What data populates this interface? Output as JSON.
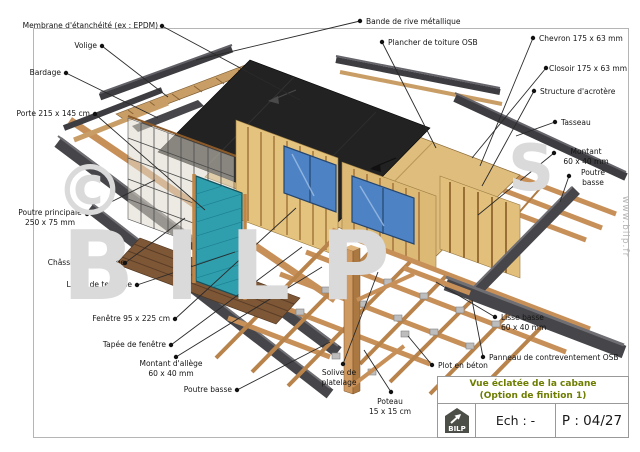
{
  "drawing_labels": [
    {
      "text": "Membrane d'étanchéité (ex : EPDM)"
    },
    {
      "text": "Volige"
    },
    {
      "text": "Bardage"
    },
    {
      "text": "Porte 215 x 145 cm"
    },
    {
      "text": "Poutre principale\n250 x 75 mm"
    },
    {
      "text": "Châssis à galandage"
    },
    {
      "text": "Lame de terrasse"
    },
    {
      "text": "Fenêtre 95 x 225 cm"
    },
    {
      "text": "Tapée de fenêtre"
    },
    {
      "text": "Montant d'allège\n60 x 40 mm"
    },
    {
      "text": "Poutre basse"
    },
    {
      "text": "Solive de\nplatelage"
    },
    {
      "text": "Poteau\n15 x 15 cm"
    },
    {
      "text": "Bande de rive métallique"
    },
    {
      "text": "Plancher de toiture OSB"
    },
    {
      "text": "Chevron 175 x 63 mm"
    },
    {
      "text": "Closoir 175 x 63 mm"
    },
    {
      "text": "Structure d'acrotère"
    },
    {
      "text": "Tasseau"
    },
    {
      "text": "Montant\n60 x 40 mm"
    },
    {
      "text": "Poutre\nbasse"
    },
    {
      "text": "Lisse basse\n60 x 40 mm"
    },
    {
      "text": "Panneau de contreventement OSB"
    },
    {
      "text": "Plot en béton"
    }
  ],
  "title_block": {
    "title_line1": "Vue éclatée de la cabane",
    "title_line2": "(Option de finition 1)",
    "scale_label": "Ech : -",
    "page_label": "P : 04/27",
    "logo_text": "BILP"
  },
  "watermark": {
    "site_url": "www.bilp.fr",
    "glyph_copyright": "©",
    "glyph_s": "S",
    "glyph_bilp": "BILP"
  },
  "colors": {
    "wood": "#c89059",
    "wood_light": "#dfbd7c",
    "membrane_black": "#222222",
    "metal_dark": "#3d3d41",
    "glass_door_teal": "#2f9fae",
    "glass_window_blue": "#4d82c4",
    "title_text_green": "#6e7d00",
    "concrete_gray": "#bdbdbd"
  }
}
